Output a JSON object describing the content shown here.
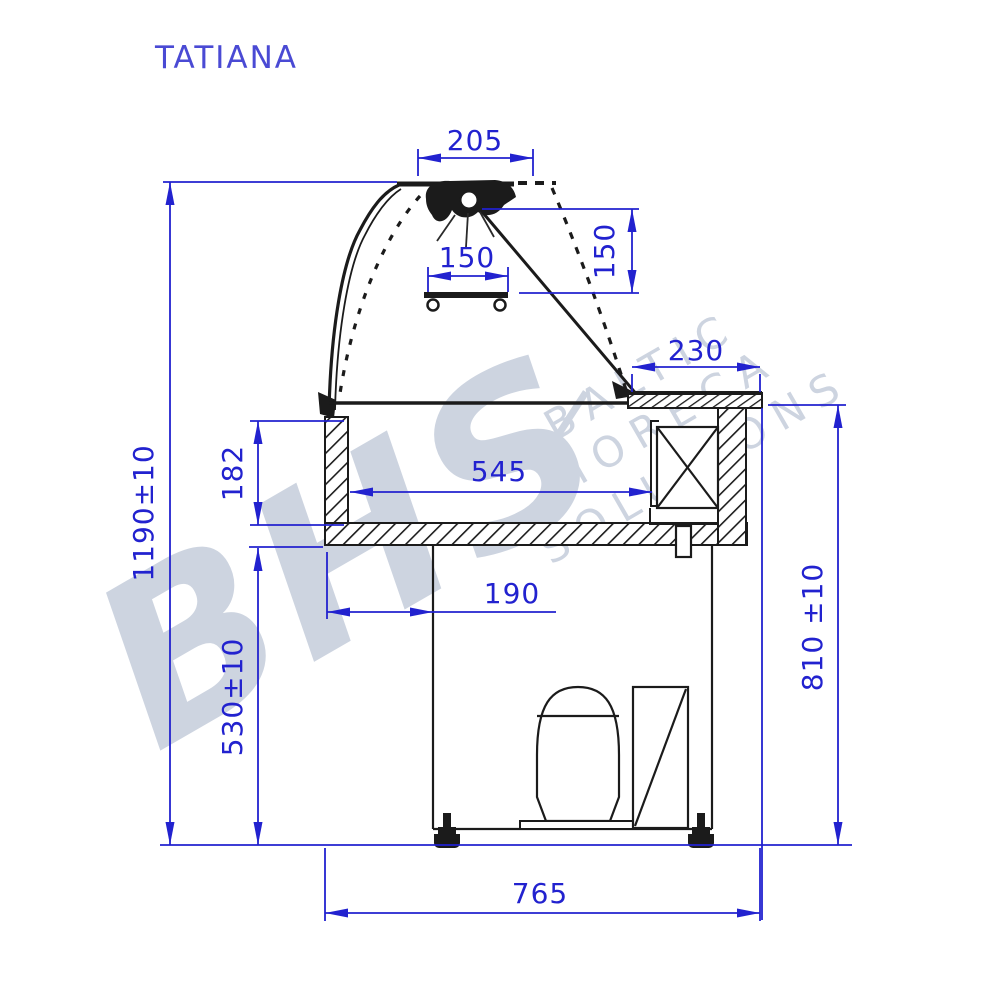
{
  "title": "TATIANA",
  "watermark": {
    "logo": "BHS",
    "words": [
      "BALTIC",
      "HORECA",
      "SOLUTIONS"
    ]
  },
  "dimensions": {
    "canopy_width": "205",
    "lamp_offset_width": "150",
    "lamp_offset_height": "150",
    "top_right_depth": "230",
    "well_depth": "182",
    "well_width": "545",
    "base_inset": "190",
    "overall_height": "1190±10",
    "understructure_height": "530±10",
    "counter_height": "810 ±10",
    "overall_depth": "765"
  },
  "colors": {
    "dimension_blue": "#2222cf",
    "title_blue": "#4a4ad4",
    "line_black": "#1b1b1b",
    "watermark_gray": "#cdd4e0"
  }
}
